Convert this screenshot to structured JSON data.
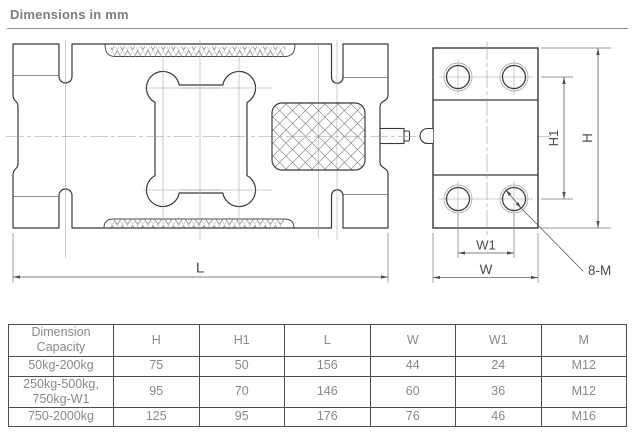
{
  "page": {
    "title": "Dimensions in mm"
  },
  "drawing": {
    "labels": {
      "length": "L",
      "width": "W",
      "width1": "W1",
      "height": "H",
      "height1": "H1",
      "bolt_callout": "8-M"
    }
  },
  "table": {
    "header": {
      "top": "Dimension",
      "bottom": "Capacity",
      "columns": [
        "H",
        "H1",
        "L",
        "W",
        "W1",
        "M"
      ]
    },
    "rows": [
      {
        "capacity": [
          "50kg-200kg",
          ""
        ],
        "values": [
          "75",
          "50",
          "156",
          "44",
          "24",
          "M12"
        ]
      },
      {
        "capacity": [
          "250kg-500kg,",
          "750kg-W1"
        ],
        "values": [
          "95",
          "70",
          "146",
          "60",
          "36",
          "M12"
        ]
      },
      {
        "capacity": [
          "750-2000kg",
          ""
        ],
        "values": [
          "125",
          "95",
          "176",
          "76",
          "46",
          "M16"
        ]
      }
    ]
  },
  "colors": {
    "outline": "#383838",
    "centerline": "#a0a0a0",
    "dimension": "#5a5a5a",
    "table_border": "#4d4d4d",
    "text_gray": "#8a8a8a",
    "title_gray": "#7d7d7d"
  }
}
